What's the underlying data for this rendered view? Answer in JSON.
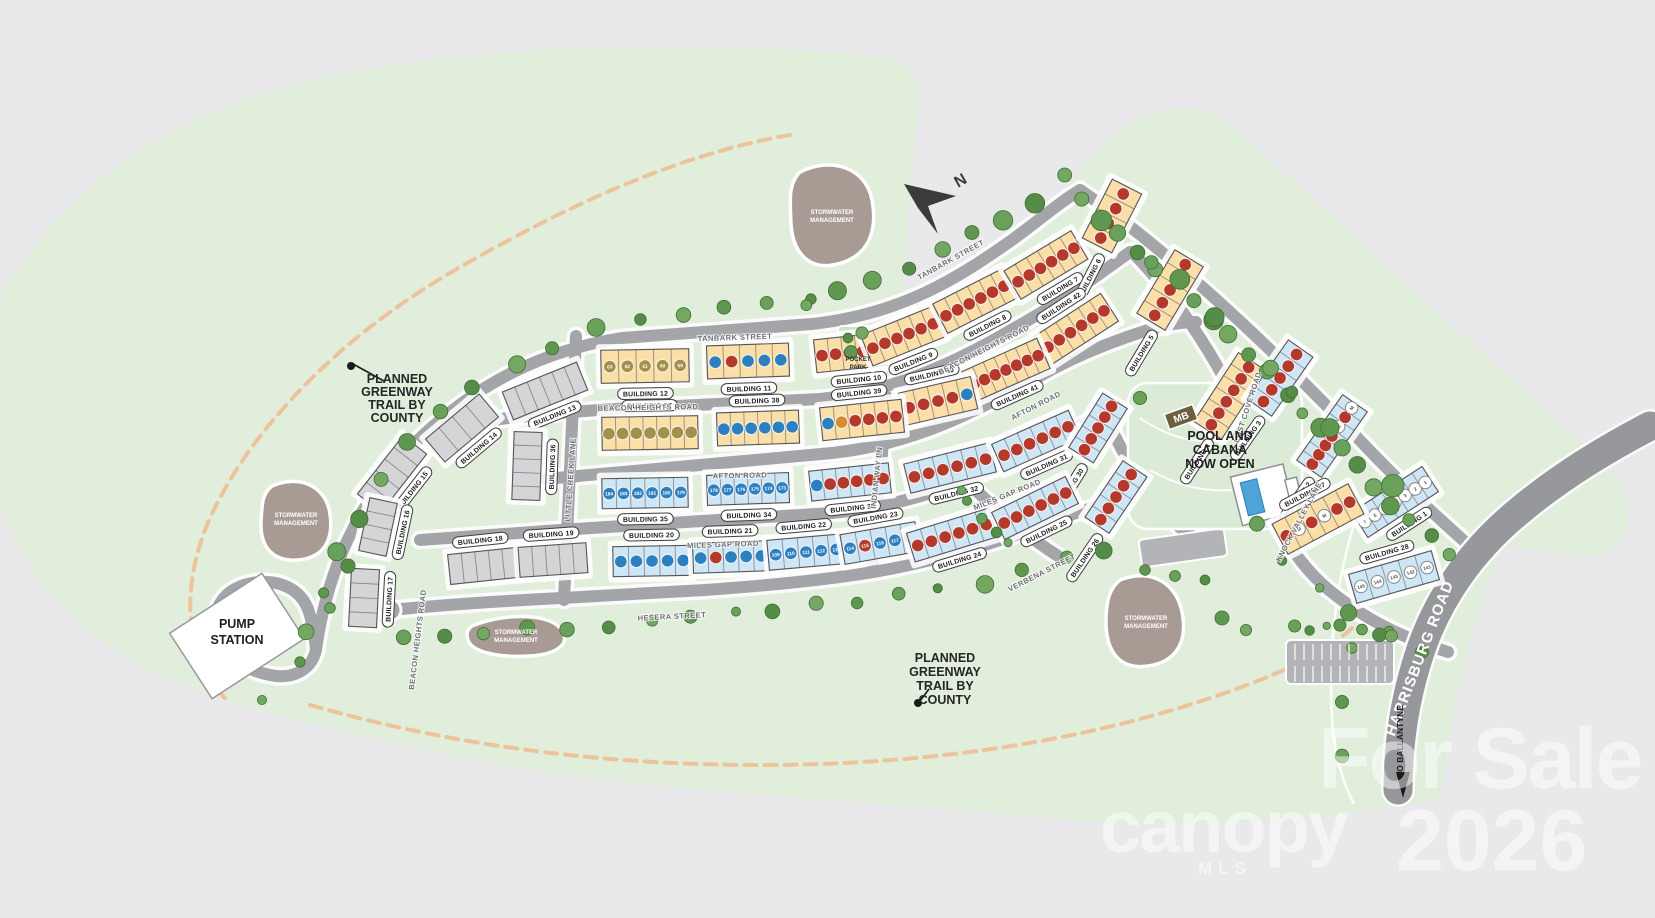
{
  "map_type": "residential community site plan",
  "colors": {
    "background": "#e9e9eb",
    "greenspace": "#e0eedb",
    "road": "#a4a5a9",
    "harrisburg_road": "#97989c",
    "trail_orange": "#ecc39c",
    "stormwater": "#a89b94",
    "building_yellow": "#fbdfa9",
    "building_blue": "#cfe6f5",
    "building_gray": "#d5d5d7",
    "unit_red": "#b5392b",
    "unit_blue": "#2d80bf",
    "unit_olive": "#a3914a",
    "unit_orange": "#d78b2f",
    "unit_white": "#ffffff",
    "tree": "#5f9750",
    "watermark": "#ffffff"
  },
  "north_label": "N",
  "annotations": {
    "greenway_left": {
      "lines": [
        "PLANNED",
        "GREENWAY",
        "TRAIL BY",
        "COUNTY"
      ],
      "x": 397,
      "y": 383,
      "dy": 13,
      "dot": [
        351,
        366
      ],
      "leader_end": [
        384,
        381
      ]
    },
    "greenway_bottom": {
      "lines": [
        "PLANNED",
        "GREENWAY",
        "TRAIL BY",
        "COUNTY"
      ],
      "x": 945,
      "y": 662,
      "dy": 14,
      "dot": [
        918,
        703
      ],
      "leader_end": [
        929,
        689
      ]
    },
    "pump_station": {
      "lines": [
        "PUMP",
        "STATION"
      ],
      "x": 237,
      "y": 628,
      "dy": 16
    },
    "pool": {
      "lines": [
        "POOL AND",
        "CABANA",
        "NOW OPEN"
      ],
      "x": 1220,
      "y": 440,
      "dy": 14
    },
    "pocket_park": {
      "lines": [
        "POCKET",
        "PARK"
      ],
      "x": 858,
      "y": 361,
      "dy": 8
    },
    "stormwater": {
      "lines": [
        "STORMWATER",
        "MANAGEMENT"
      ],
      "sites": [
        [
          832,
          214
        ],
        [
          296,
          517
        ],
        [
          516,
          634
        ],
        [
          1146,
          620
        ]
      ]
    },
    "mb_sign": {
      "label": "MB",
      "x": 1181,
      "y": 417,
      "angle": -20
    },
    "to_ballantyne": {
      "label": "TO BALLANTYNE",
      "x": 1403,
      "y": 741
    }
  },
  "streets": [
    {
      "name": "TANBARK STREET",
      "x": 735,
      "y": 340,
      "angle": -2
    },
    {
      "name": "TANBARK STREET",
      "x": 952,
      "y": 262,
      "angle": -29
    },
    {
      "name": "BEACON HEIGHTS ROAD",
      "x": 648,
      "y": 410,
      "angle": -1
    },
    {
      "name": "BEACON HEIGHTS ROAD",
      "x": 985,
      "y": 352,
      "angle": -27
    },
    {
      "name": "BEACON HEIGHTS ROAD",
      "x": 420,
      "y": 640,
      "angle": -83
    },
    {
      "name": "AFTON ROAD",
      "x": 740,
      "y": 478,
      "angle": -1
    },
    {
      "name": "AFTON ROAD",
      "x": 1037,
      "y": 408,
      "angle": -27
    },
    {
      "name": "MILES GAP ROAD",
      "x": 723,
      "y": 547,
      "angle": -2
    },
    {
      "name": "MILES GAP ROAD",
      "x": 1008,
      "y": 497,
      "angle": -22
    },
    {
      "name": "HESERA STREET",
      "x": 672,
      "y": 619,
      "angle": -3
    },
    {
      "name": "LITTLE CREEK LANE",
      "x": 573,
      "y": 480,
      "angle": -86
    },
    {
      "name": "INDIAN WAY LN",
      "x": 879,
      "y": 478,
      "angle": -84
    },
    {
      "name": "VERBENA STREET",
      "x": 1043,
      "y": 575,
      "angle": -27
    },
    {
      "name": "LOST COVE ROAD",
      "x": 1250,
      "y": 408,
      "angle": -72
    },
    {
      "name": "KNOCK VALLEY LANE",
      "x": 1301,
      "y": 523,
      "angle": -62
    },
    {
      "name": "HARRISBURG ROAD",
      "x": 1424,
      "y": 660,
      "angle": -69,
      "big": true
    }
  ],
  "building_label_prefix": "BUILDING",
  "buildings": [
    {
      "n": 12,
      "x": 645,
      "y": 366,
      "a": -1,
      "l": 88,
      "d": 33,
      "c": "y",
      "lp": 1,
      "u": "o:63,o:62,o:61,o:60,o:59"
    },
    {
      "n": 11,
      "x": 748,
      "y": 361,
      "a": -2,
      "l": 82,
      "d": 33,
      "c": "y",
      "lp": 1,
      "u": "b,r,b,b,b"
    },
    {
      "n": 10,
      "x": 856,
      "y": 352,
      "a": -6,
      "l": 82,
      "d": 33,
      "c": "y",
      "lp": 1,
      "u": "r,r,r,r,r,r"
    },
    {
      "n": 9,
      "x": 903,
      "y": 336,
      "a": -22,
      "l": 78,
      "d": 33,
      "c": "y",
      "lp": 1,
      "u": "r,r,r,r,r,r"
    },
    {
      "n": 8,
      "x": 975,
      "y": 301,
      "a": -27,
      "l": 78,
      "d": 33,
      "c": "y",
      "lp": 1,
      "u": "r,r,r,r,r,r"
    },
    {
      "n": 7,
      "x": 1046,
      "y": 265,
      "a": -31,
      "l": 78,
      "d": 33,
      "c": "y",
      "lp": 1,
      "u": "r,r,r,r,r,r"
    },
    {
      "n": 6,
      "x": 1112,
      "y": 216,
      "a": -63,
      "l": 66,
      "d": 33,
      "c": "y",
      "lp": 0,
      "u": "r,r,r,r"
    },
    {
      "n": 5,
      "x": 1170,
      "y": 290,
      "a": -59,
      "l": 74,
      "d": 33,
      "c": "y",
      "lp": 0,
      "u": "r,r,r,r,r"
    },
    {
      "n": 4,
      "x": 1230,
      "y": 396,
      "a": -57,
      "l": 82,
      "d": 33,
      "c": "y",
      "lp": 0,
      "u": "r,r,r,r,r,r"
    },
    {
      "n": 3,
      "x": 1280,
      "y": 378,
      "a": -55,
      "l": 72,
      "d": 30,
      "c": "b",
      "lp": 0,
      "u": "r,r,r,r,r"
    },
    {
      "n": 2,
      "x": 1332,
      "y": 436,
      "a": -55,
      "l": 80,
      "d": 30,
      "c": "b",
      "lp": 0,
      "u": "r,r,r,r,m,r,m"
    },
    {
      "n": 1,
      "x": 1395,
      "y": 502,
      "a": -33,
      "l": 84,
      "d": 30,
      "c": "b",
      "lp": 1,
      "u": "w:7,w:6,w:5,w:4,w:3,w:2,w:1"
    },
    {
      "n": 42,
      "x": 1076,
      "y": 329,
      "a": -33,
      "l": 80,
      "d": 33,
      "c": "y",
      "lp": -1,
      "u": "r,r,r,r,r,r"
    },
    {
      "n": 41,
      "x": 1006,
      "y": 370,
      "a": -24,
      "l": 82,
      "d": 33,
      "c": "y",
      "lp": 1,
      "u": "r,r,r,r,r,r,r"
    },
    {
      "n": 40,
      "x": 938,
      "y": 401,
      "a": -13,
      "l": 74,
      "d": 33,
      "c": "y",
      "lp": -1,
      "u": "r,r,r,r,b"
    },
    {
      "n": 37,
      "x": 650,
      "y": 433,
      "a": -1,
      "l": 96,
      "d": 33,
      "c": "y",
      "lp": -1,
      "u": "o,o,o,o,o,o,o"
    },
    {
      "n": 38,
      "x": 758,
      "y": 428,
      "a": -2,
      "l": 82,
      "d": 33,
      "c": "y",
      "lp": -1,
      "u": "b,b,b,b,b,b"
    },
    {
      "n": 39,
      "x": 862,
      "y": 420,
      "a": -6,
      "l": 82,
      "d": 33,
      "c": "y",
      "lp": -1,
      "u": "b,n,r,r,r,r"
    },
    {
      "n": 35,
      "x": 645,
      "y": 493,
      "a": -1,
      "l": 86,
      "d": 30,
      "c": "b",
      "lp": 1,
      "u": "b:184,b:183,b:182,b:181,b:180,b:179"
    },
    {
      "n": 34,
      "x": 748,
      "y": 489,
      "a": -2,
      "l": 82,
      "d": 30,
      "c": "b",
      "lp": 1,
      "u": "b:178,b:177,b:176,b:175,b:174,b:173"
    },
    {
      "n": 33,
      "x": 850,
      "y": 482,
      "a": -6,
      "l": 80,
      "d": 30,
      "c": "b",
      "lp": 1,
      "u": "b,r,r,r,r,r"
    },
    {
      "n": 32,
      "x": 950,
      "y": 468,
      "a": -14,
      "l": 88,
      "d": 30,
      "c": "b",
      "lp": 1,
      "u": "r,r,r,r,r,r"
    },
    {
      "n": 31,
      "x": 1036,
      "y": 441,
      "a": -24,
      "l": 84,
      "d": 30,
      "c": "b",
      "lp": 1,
      "u": "r,r,r,r,r,r"
    },
    {
      "n": 30,
      "x": 1098,
      "y": 428,
      "a": -58,
      "l": 64,
      "d": 29,
      "c": "b",
      "lp": 0,
      "u": "r,r,r,r,r"
    },
    {
      "n": 26,
      "x": 1116,
      "y": 497,
      "a": -56,
      "l": 68,
      "d": 29,
      "c": "b",
      "lp": 0,
      "u": "r,r,r,r,r"
    },
    {
      "n": 20,
      "x": 652,
      "y": 561,
      "a": -1,
      "l": 78,
      "d": 30,
      "c": "b",
      "lp": -1,
      "u": "b,b,b,b,b"
    },
    {
      "n": 21,
      "x": 731,
      "y": 557,
      "a": -2,
      "l": 76,
      "d": 30,
      "c": "b",
      "lp": -1,
      "u": "b,r,b,b,b"
    },
    {
      "n": 22,
      "x": 806,
      "y": 552,
      "a": -5,
      "l": 76,
      "d": 30,
      "c": "b",
      "lp": -1,
      "u": "b:109,b:110,b:111,b:112,b:113"
    },
    {
      "n": 23,
      "x": 880,
      "y": 543,
      "a": -10,
      "l": 76,
      "d": 30,
      "c": "b",
      "lp": -1,
      "u": "b:114,r:115,b:116,b:117,r:118"
    },
    {
      "n": 24,
      "x": 952,
      "y": 535,
      "a": -17,
      "l": 86,
      "d": 30,
      "c": "b",
      "lp": 1,
      "u": "r,r,r,r,r,r"
    },
    {
      "n": 25,
      "x": 1035,
      "y": 508,
      "a": -26,
      "l": 82,
      "d": 30,
      "c": "b",
      "lp": 1,
      "u": "r,r,r,r,r,r"
    },
    {
      "n": 27,
      "x": 1318,
      "y": 519,
      "a": -28,
      "l": 86,
      "d": 34,
      "c": "y",
      "lp": -1,
      "u": "r,m,r,m,r,r"
    },
    {
      "n": 28,
      "x": 1394,
      "y": 577,
      "a": -16,
      "l": 86,
      "d": 30,
      "c": "b",
      "lp": -1,
      "u": "w:145,w:144,w:143,w:142,w:141"
    },
    {
      "n": 13,
      "x": 545,
      "y": 391,
      "a": -22,
      "l": 80,
      "d": 30,
      "c": "g",
      "lp": 1,
      "u": "g,g,g,g,g,g"
    },
    {
      "n": 14,
      "x": 462,
      "y": 428,
      "a": -40,
      "l": 70,
      "d": 30,
      "c": "g",
      "lp": 1,
      "u": "g,g,g,g"
    },
    {
      "n": 15,
      "x": 392,
      "y": 474,
      "a": -52,
      "l": 74,
      "d": 30,
      "c": "g",
      "lp": 1,
      "u": "g,g,g,g,g"
    },
    {
      "n": 16,
      "x": 378,
      "y": 527,
      "a": -78,
      "l": 54,
      "d": 28,
      "c": "g",
      "lp": 1,
      "u": "g,g,g,g"
    },
    {
      "n": 17,
      "x": 364,
      "y": 598,
      "a": -87,
      "l": 58,
      "d": 28,
      "c": "g",
      "lp": 1,
      "u": "g,g,g,g"
    },
    {
      "n": 18,
      "x": 483,
      "y": 566,
      "a": -6,
      "l": 68,
      "d": 30,
      "c": "g",
      "lp": -1,
      "u": "g,g,g,g,g"
    },
    {
      "n": 19,
      "x": 553,
      "y": 560,
      "a": -4,
      "l": 68,
      "d": 30,
      "c": "g",
      "lp": -1,
      "u": "g,g,g,g,g"
    },
    {
      "n": 36,
      "x": 527,
      "y": 466,
      "a": -88,
      "l": 68,
      "d": 28,
      "c": "g",
      "lp": 1,
      "u": "g,g,g,g,g"
    }
  ],
  "watermark": {
    "for_sale": "For Sale",
    "brand": "canopy",
    "mls": "MLS",
    "year": "2026"
  }
}
